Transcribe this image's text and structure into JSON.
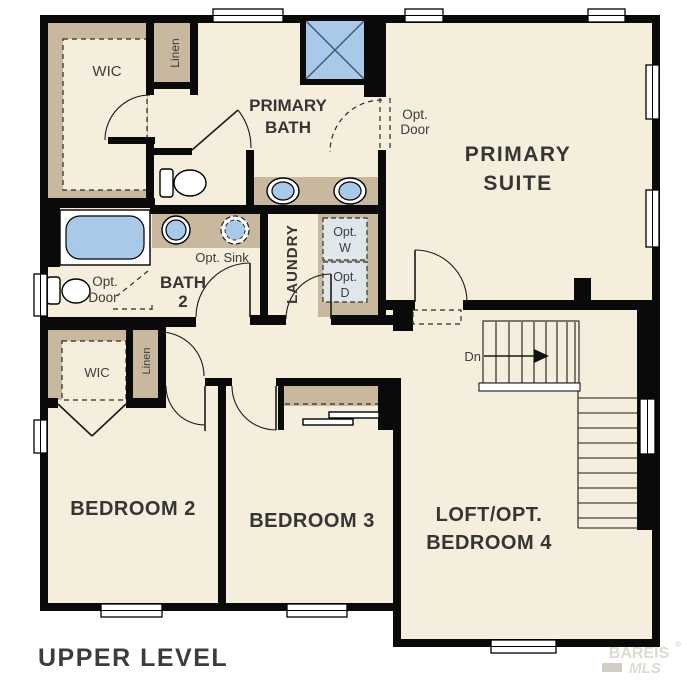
{
  "plan": {
    "title": "UPPER LEVEL",
    "watermark": {
      "name": "BAREIS",
      "reg": "®",
      "sub": "MLS"
    },
    "colors": {
      "floor": "#f6eedd",
      "closet": "#c8b89e",
      "fixture": "#a9c9e9",
      "wd": "#dfe7ec",
      "wall": "#0a0a0a",
      "label": "#3c3c3c"
    },
    "labels": {
      "wic1": "WIC",
      "linen1": "Linen",
      "primary_bath_1": "PRIMARY",
      "primary_bath_2": "BATH",
      "opt_door_top_1": "Opt.",
      "opt_door_top_2": "Door",
      "primary_suite_1": "PRIMARY",
      "primary_suite_2": "SUITE",
      "opt_sink": "Opt. Sink",
      "bath2_1": "BATH",
      "bath2_2": "2",
      "laundry": "LAUNDRY",
      "opt_w_1": "Opt.",
      "opt_w_2": "W",
      "opt_d_1": "Opt.",
      "opt_d_2": "D",
      "opt_door_left_1": "Opt.",
      "opt_door_left_2": "Door",
      "wic2": "WIC",
      "linen2": "Linen",
      "stairs_dn": "Dn",
      "bedroom2": "BEDROOM 2",
      "bedroom3": "BEDROOM 3",
      "loft_1": "LOFT/OPT.",
      "loft_2": "BEDROOM 4"
    }
  }
}
